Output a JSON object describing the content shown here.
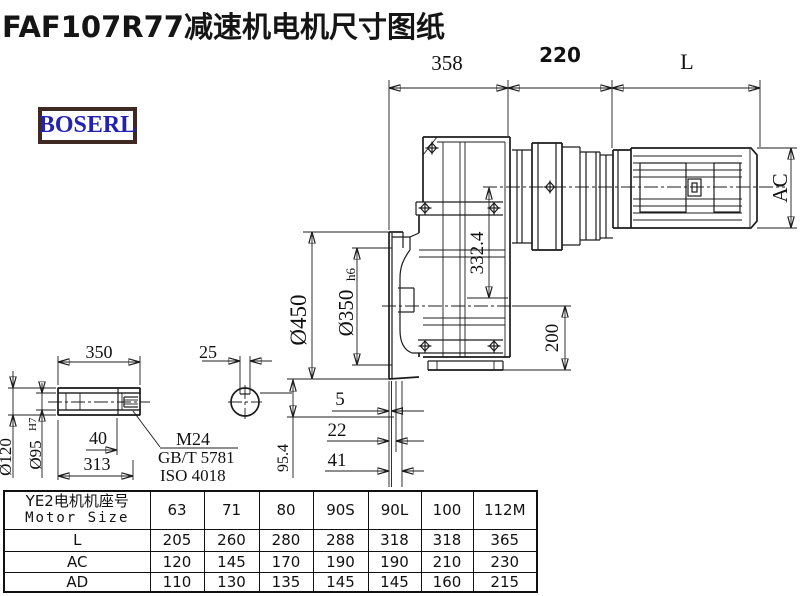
{
  "title": "FAF107R77减速机电机尺寸图纸",
  "logo": {
    "text": "BOSERL",
    "border_color": "#3f2a23",
    "text_color": "#2222b4"
  },
  "dims": {
    "top_358": "358",
    "top_220": "220",
    "top_L": "L",
    "ac": "AC",
    "v332": "332.4",
    "dia450": "Ø450",
    "dia350": "Ø350",
    "dia350_suffix": "h6",
    "v200": "200",
    "v95_4": "95.4",
    "off5": "5",
    "off22": "22",
    "off41": "41",
    "shaft_350": "350",
    "key_25": "25",
    "dia120": "Ø120",
    "dia95": "Ø95",
    "dia95_suffix": "H7",
    "depth_40": "40",
    "len_313": "313",
    "thread": "M24",
    "thread_std1": "GB/T 5781",
    "thread_std2": "ISO 4018"
  },
  "table": {
    "header_cn": "YE2电机机座号",
    "header_en": "Motor Size",
    "sizes": [
      "63",
      "71",
      "80",
      "90S",
      "90L",
      "100",
      "112M"
    ],
    "rows": [
      {
        "label": "L",
        "values": [
          "205",
          "260",
          "280",
          "288",
          "318",
          "318",
          "365"
        ]
      },
      {
        "label": "AC",
        "values": [
          "120",
          "145",
          "170",
          "190",
          "190",
          "210",
          "230"
        ]
      },
      {
        "label": "AD",
        "values": [
          "110",
          "130",
          "135",
          "145",
          "145",
          "160",
          "215"
        ]
      }
    ]
  }
}
